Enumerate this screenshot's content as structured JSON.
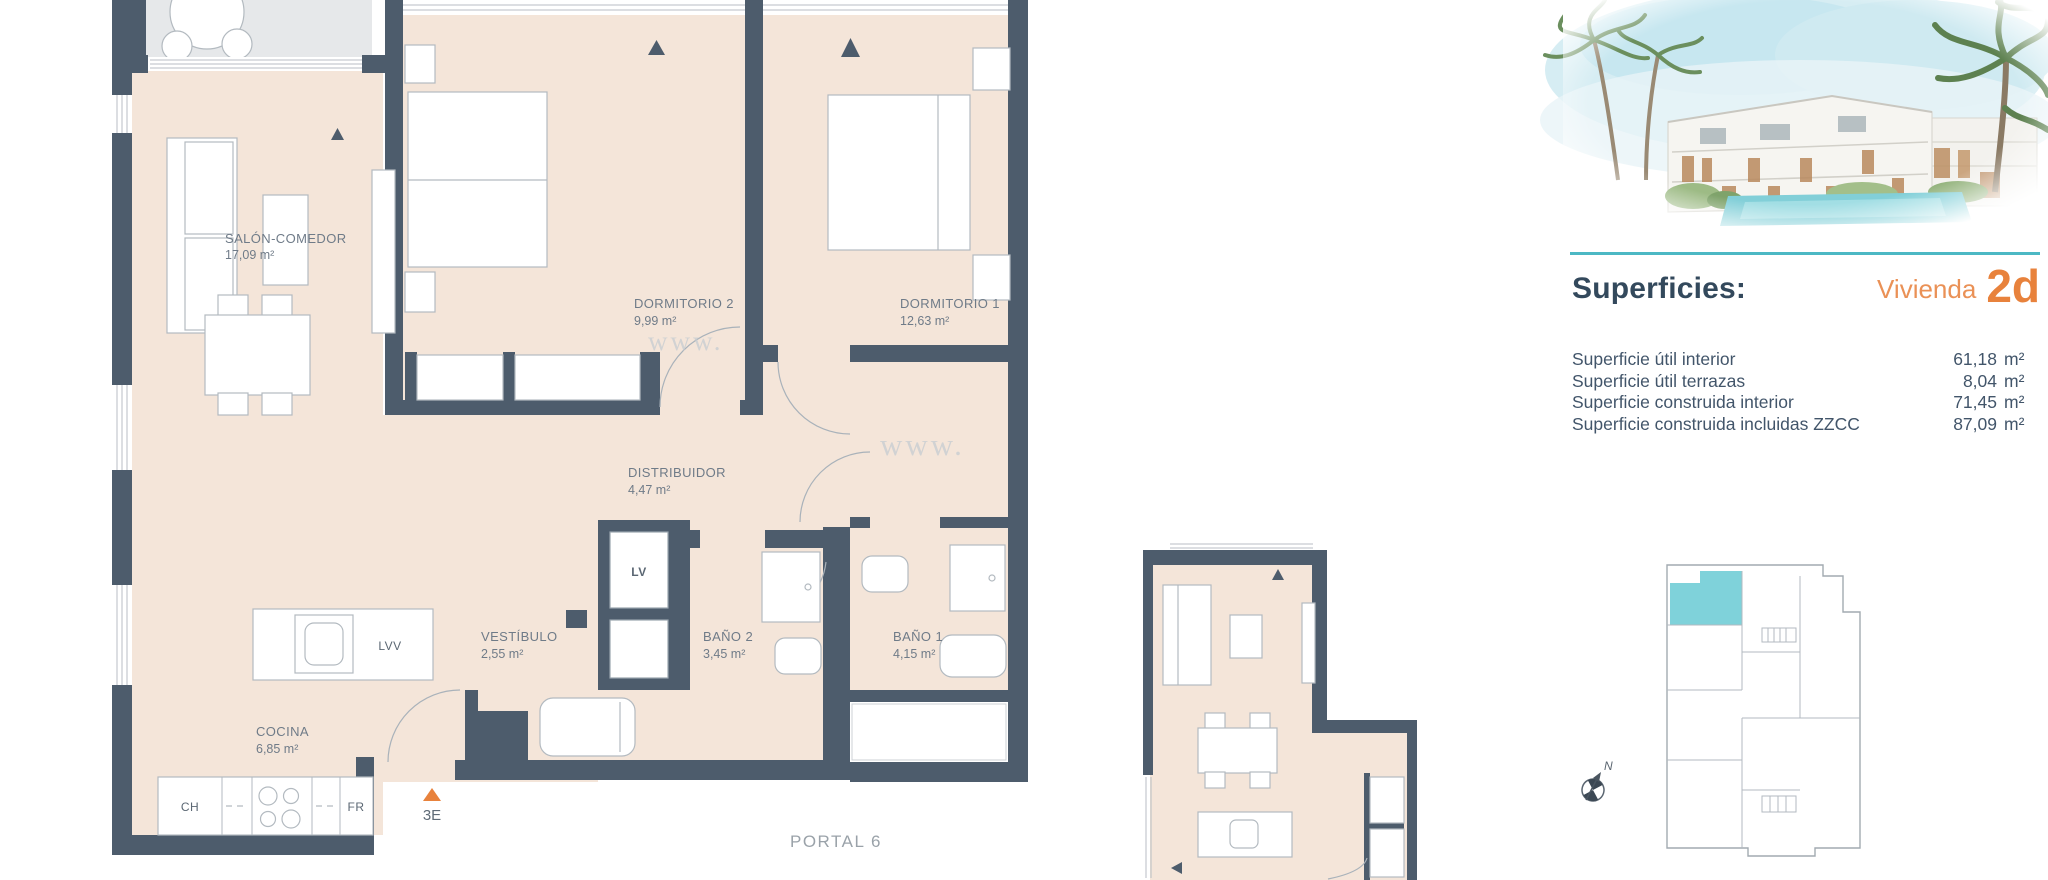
{
  "plan": {
    "rooms": [
      {
        "name": "SALÓN-COMEDOR",
        "area": "17,09 m²"
      },
      {
        "name": "DORMITORIO 2",
        "area": "9,99 m²"
      },
      {
        "name": "DORMITORIO 1",
        "area": "12,63 m²"
      },
      {
        "name": "DISTRIBUIDOR",
        "area": "4,47 m²"
      },
      {
        "name": "VESTÍBULO",
        "area": "2,55 m²"
      },
      {
        "name": "BAÑO 2",
        "area": "3,45 m²"
      },
      {
        "name": "BAÑO 1",
        "area": "4,15 m²"
      },
      {
        "name": "COCINA",
        "area": "6,85 m²"
      }
    ],
    "appliances": {
      "lv": "LV",
      "lvv": "LVV",
      "ch": "CH",
      "fr": "FR"
    },
    "entrance_label": "3E",
    "portal_label": "PORTAL 6",
    "watermark": "www."
  },
  "panel": {
    "heading": "Superficies:",
    "unit_label": "Vivienda",
    "unit_code": "2d",
    "rows": [
      {
        "label": "Superficie útil interior",
        "value": "61,18",
        "unit": "m²"
      },
      {
        "label": "Superficie útil terrazas",
        "value": "8,04",
        "unit": "m²"
      },
      {
        "label": "Superficie construida interior",
        "value": "71,45",
        "unit": "m²"
      },
      {
        "label": "Superficie construida incluidas ZZCC",
        "value": "87,09",
        "unit": "m²"
      }
    ],
    "compass_label": "N"
  },
  "colors": {
    "wall": "#4d5c6c",
    "floor": "#f4e5d9",
    "terrace": "#e6e8ea",
    "accent_teal": "#4cb8c4",
    "highlight_unit": "#7fd2da",
    "accent_orange": "#e8823c"
  }
}
